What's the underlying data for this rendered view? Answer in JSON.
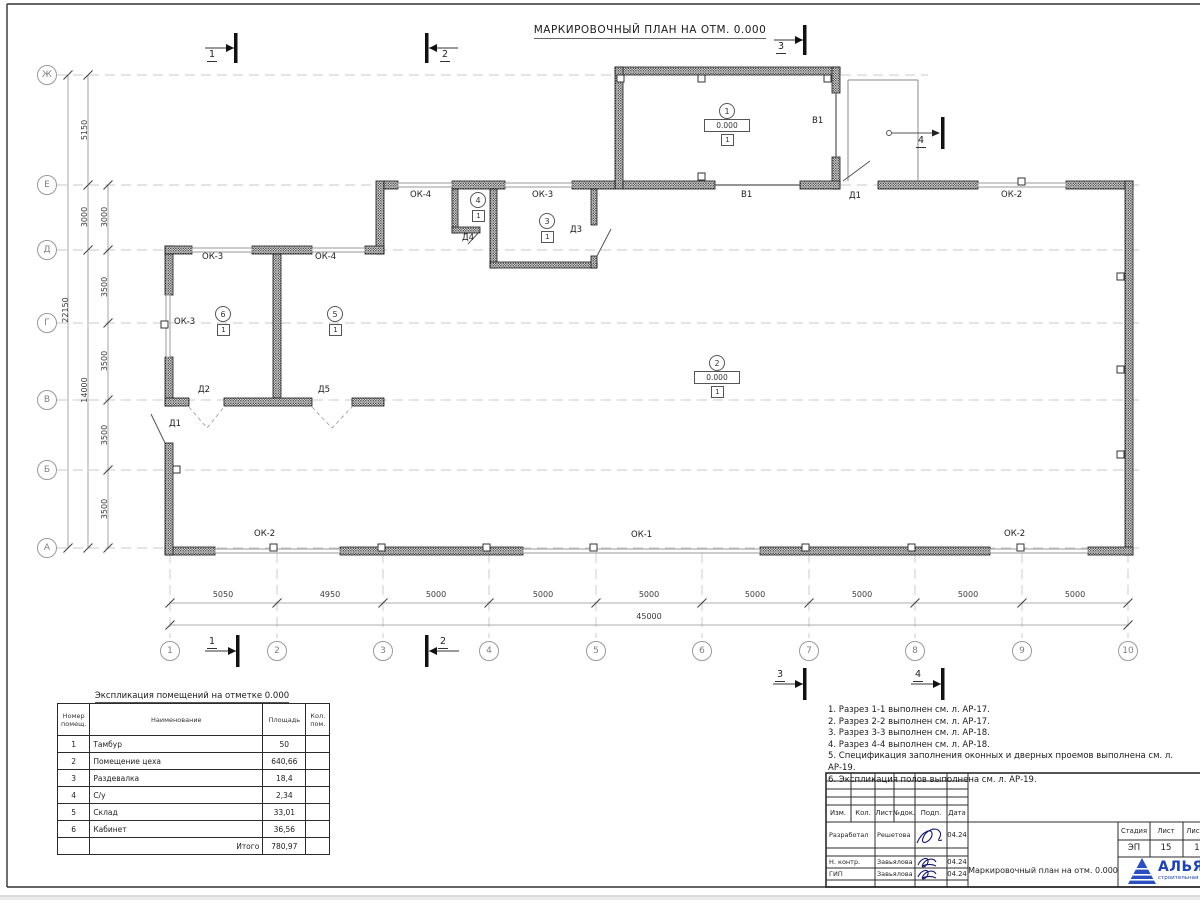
{
  "plan_title": "МАРКИРОВОЧНЫЙ ПЛАН НА ОТМ. 0.000",
  "grid": {
    "rows": [
      "Ж",
      "Е",
      "Д",
      "Г",
      "В",
      "Б",
      "А"
    ],
    "cols": [
      "1",
      "2",
      "3",
      "4",
      "5",
      "6",
      "7",
      "8",
      "9",
      "10"
    ]
  },
  "dims": {
    "total_height": "22150",
    "h_spans": [
      "5150",
      "3000",
      "14000"
    ],
    "h_inner": [
      "3000",
      "3500",
      "3500",
      "3500",
      "3500"
    ],
    "w_spans": [
      "5050",
      "4950",
      "5000",
      "5000",
      "5000",
      "5000",
      "5000",
      "5000",
      "5000"
    ],
    "total_width": "45000"
  },
  "marks": {
    "ok1": "ОК-1",
    "ok2": "ОК-2",
    "ok3": "ОК-3",
    "ok4": "ОК-4",
    "d1": "Д1",
    "d2": "Д2",
    "d3": "Д3",
    "d4": "Д4",
    "d5": "Д5",
    "v1": "В1"
  },
  "rooms": {
    "r1": {
      "num": "1",
      "elev": "0.000",
      "floor": "1"
    },
    "r2": {
      "num": "2",
      "elev": "0.000",
      "floor": "1"
    },
    "r3": {
      "num": "3",
      "floor": "1"
    },
    "r4": {
      "num": "4",
      "floor": "1"
    },
    "r5": {
      "num": "5",
      "floor": "1"
    },
    "r6": {
      "num": "6",
      "floor": "1"
    }
  },
  "sections": {
    "s1": "1",
    "s2": "2",
    "s3": "3",
    "s4": "4"
  },
  "explication": {
    "title": "Экспликация помещений на отметке 0.000",
    "col_headers": [
      "Номер помещ.",
      "Наименование",
      "Площадь",
      "Кол. пом."
    ],
    "rows": [
      {
        "num": "1",
        "name": "Тамбур",
        "area": "50"
      },
      {
        "num": "2",
        "name": "Помещение цеха",
        "area": "640,66"
      },
      {
        "num": "3",
        "name": "Раздевалка",
        "area": "18,4"
      },
      {
        "num": "4",
        "name": "С/у",
        "area": "2,34"
      },
      {
        "num": "5",
        "name": "Склад",
        "area": "33,01"
      },
      {
        "num": "6",
        "name": "Кабинет",
        "area": "36,56"
      }
    ],
    "total_label": "Итого",
    "total_area": "780,97"
  },
  "notes": [
    "1. Разрез 1-1 выполнен см. л. АР-17.",
    "2. Разрез 2-2 выполнен см. л. АР-17.",
    "3. Разрез 3-3 выполнен см. л. АР-18.",
    "4. Разрез 4-4 выполнен см. л. АР-18.",
    "5. Спецификация заполнения оконных и дверных проемов выполнена см. л. АР-19.",
    "6. Экспликация полов выполнена см. л. АР-19."
  ],
  "titleblock": {
    "change_cols": [
      "Изм.",
      "Кол.",
      "Лист",
      "№док.",
      "Подп.",
      "Дата"
    ],
    "staff": [
      {
        "role": "Разработал",
        "name": "Решетова",
        "date": "04.24"
      },
      {
        "role": "Н. контр.",
        "name": "Завьялова",
        "date": "04.24"
      },
      {
        "role": "ГИП",
        "name": "Завьялова",
        "date": "04.24"
      }
    ],
    "doc_title": "Маркировочный план на отм. 0.000",
    "stage_label": "Стадия",
    "sheet_label": "Лист",
    "sheets_label": "Листов",
    "stage": "ЭП",
    "sheet": "15",
    "sheets": "1",
    "company": "АЛЬЯНС",
    "company_sub": "строительная компания"
  }
}
